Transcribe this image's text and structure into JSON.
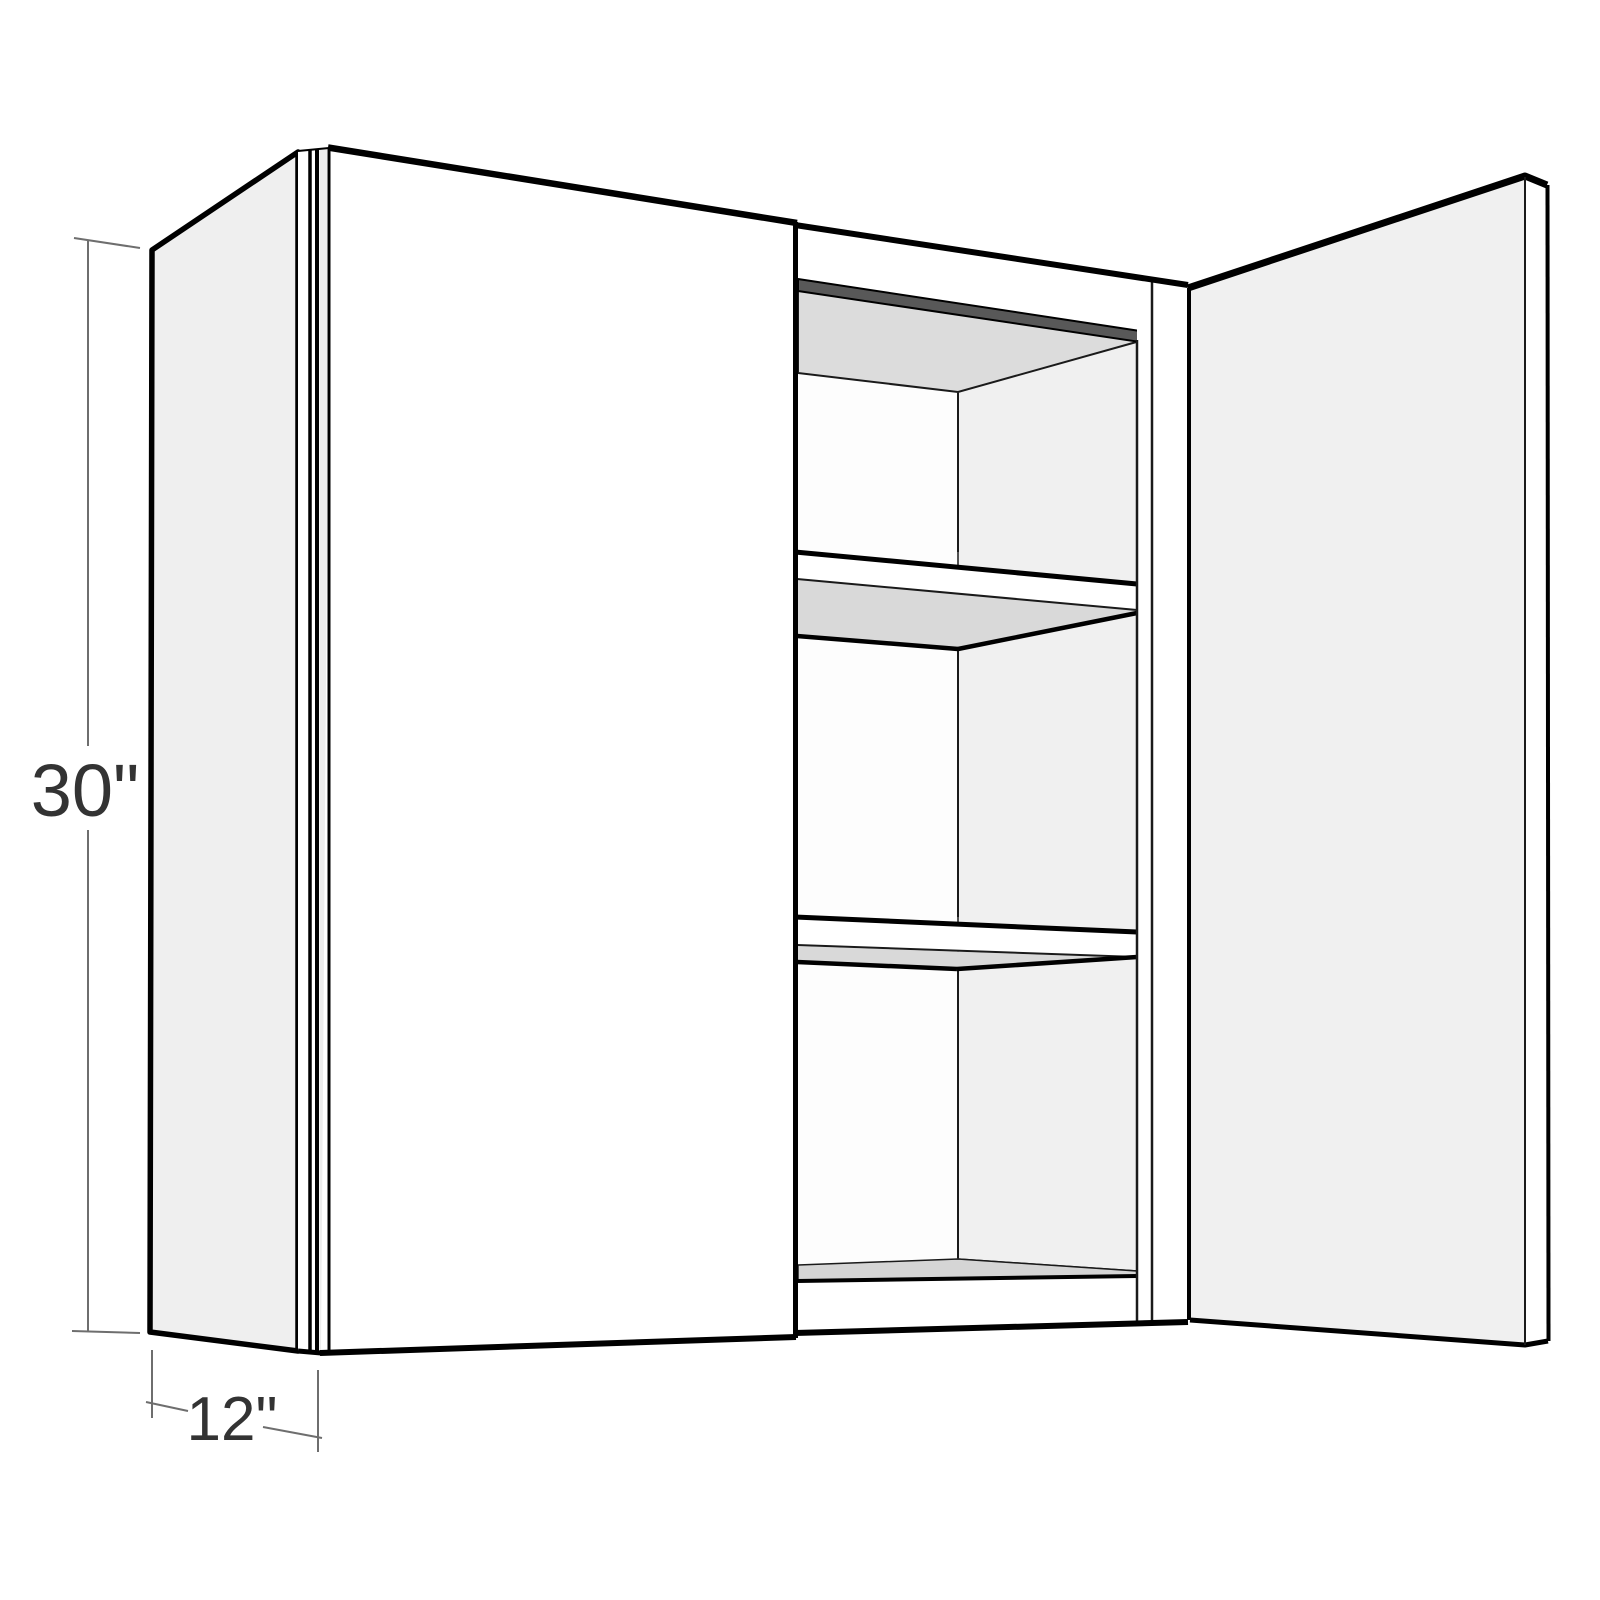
{
  "figure": {
    "kind": "cabinet-3d-line-drawing",
    "description": "Wall cabinet shown in 3D with left door closed, right door open, two interior shelves",
    "height_dimension": {
      "label": "30\""
    },
    "depth_dimension": {
      "label": "12\""
    },
    "colors": {
      "background": "#ffffff",
      "door_face": "#ffffff",
      "side_panel": "#efefef",
      "open_door_inner_face": "#f0f0f0",
      "interior_ceiling": "#dcdcdc",
      "interior_right_wall": "#f0f0f0",
      "interior_back_wall": "#fdfdfd",
      "shelf_underside": "#d9d9d9",
      "cabinet_floor": "#d5d5d5",
      "top_edge_shadow": "#585858",
      "outline": "#000000",
      "dimension_line": "#6e6e6e",
      "dimension_text": "#333333"
    }
  }
}
